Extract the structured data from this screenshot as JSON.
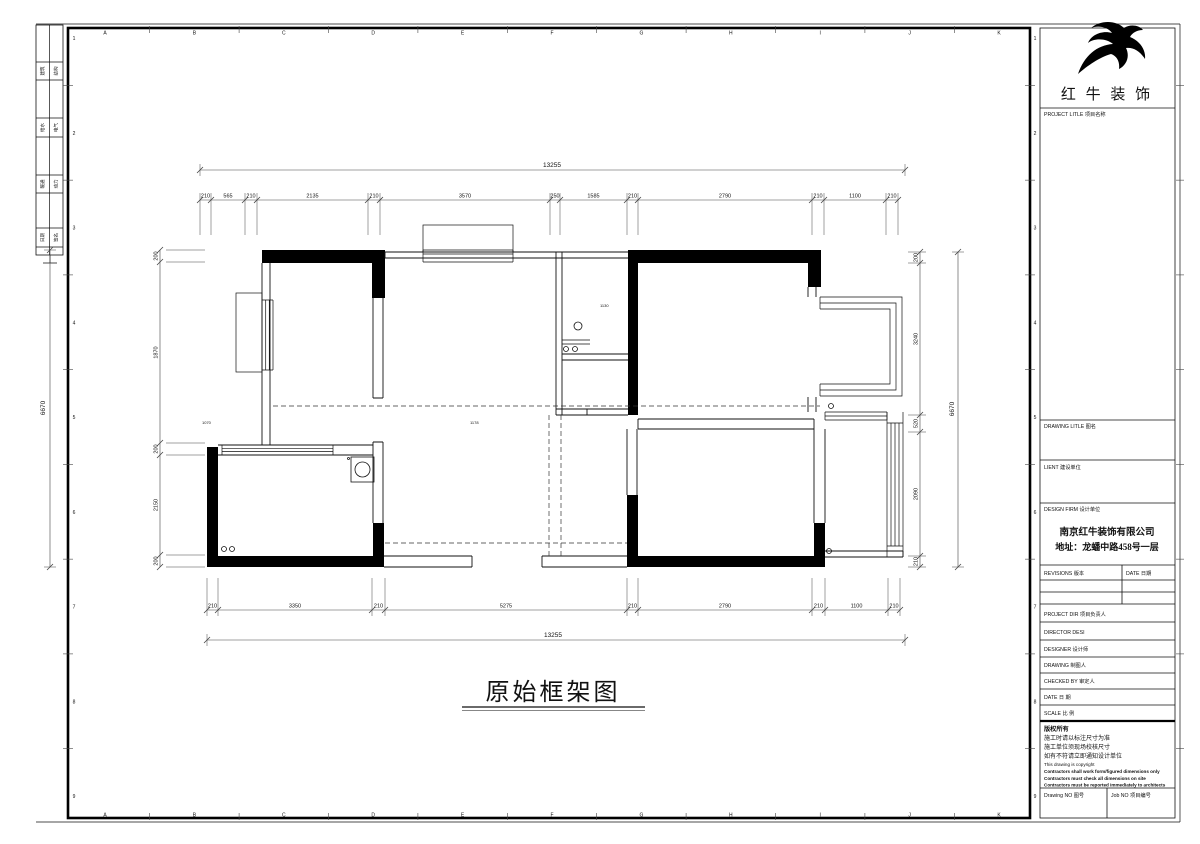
{
  "frame": {
    "top_letters": [
      "A",
      "B",
      "C",
      "D",
      "E",
      "F",
      "G",
      "H",
      "I",
      "J",
      "K"
    ],
    "side_numbers": [
      "1",
      "2",
      "3",
      "4",
      "5",
      "6",
      "7",
      "8",
      "9"
    ],
    "strip_labels": [
      "建筑",
      "结构",
      "给水",
      "电气",
      "暖通",
      "动力",
      "日期",
      "签名"
    ]
  },
  "plan": {
    "title": "原始框架图",
    "tiny_labels": [
      "1130",
      "1178",
      "1070"
    ],
    "dims": {
      "top_total": "13255",
      "top": [
        "210",
        "565",
        "210",
        "2135",
        "210",
        "3570",
        "250",
        "1585",
        "210",
        "2790",
        "210",
        "1100",
        "210"
      ],
      "bottom_total": "13255",
      "bottom": [
        "210",
        "3350",
        "210",
        "5275",
        "210",
        "2790",
        "210",
        "1100",
        "210"
      ],
      "left_total": "6670",
      "left": [
        "200",
        "1870",
        "200",
        "2150",
        "200"
      ],
      "right_total": "6670",
      "right": [
        "200",
        "3240",
        "520",
        "2090",
        "210"
      ]
    }
  },
  "titleblock": {
    "brand": "红 牛 装 饰",
    "project_title": "PROJECT LITLE  项目名称",
    "drawing_title": "DRAWING LITLE  图名",
    "client": "LIENT  建设单位",
    "design_firm": "DESIGN FIRM  设计单位",
    "firm_name": "南京红牛装饰有限公司",
    "firm_addr": "地址：龙蟠中路458号一层",
    "revisions": "REVISIONS  版本",
    "date_col": "DATE  日期",
    "project_dir": "PROJECT DIR   项目负责人",
    "director": "DIRECTOR DESI",
    "designer": "DESIGNER       设计师",
    "drawing_by": "DRAWING       制图人",
    "checked_by": "CHECKED BY   审定人",
    "date_row": "DATE              日  期",
    "scale_row": "SCALE            比  例",
    "copyright": [
      "版权所有",
      "施工时请以标注尺寸为准",
      "施工单位须现场校核尺寸",
      "如有不符请立即通知设计单位",
      "This drawing is copyright",
      "Contractors shall work form/figured dimensions only",
      "Contractors must check all dimensions on site",
      "Contractors must be reported immediately to architects"
    ],
    "drawing_no": "Drawing NO  图号",
    "job_no": "Job NO  项目编号"
  }
}
